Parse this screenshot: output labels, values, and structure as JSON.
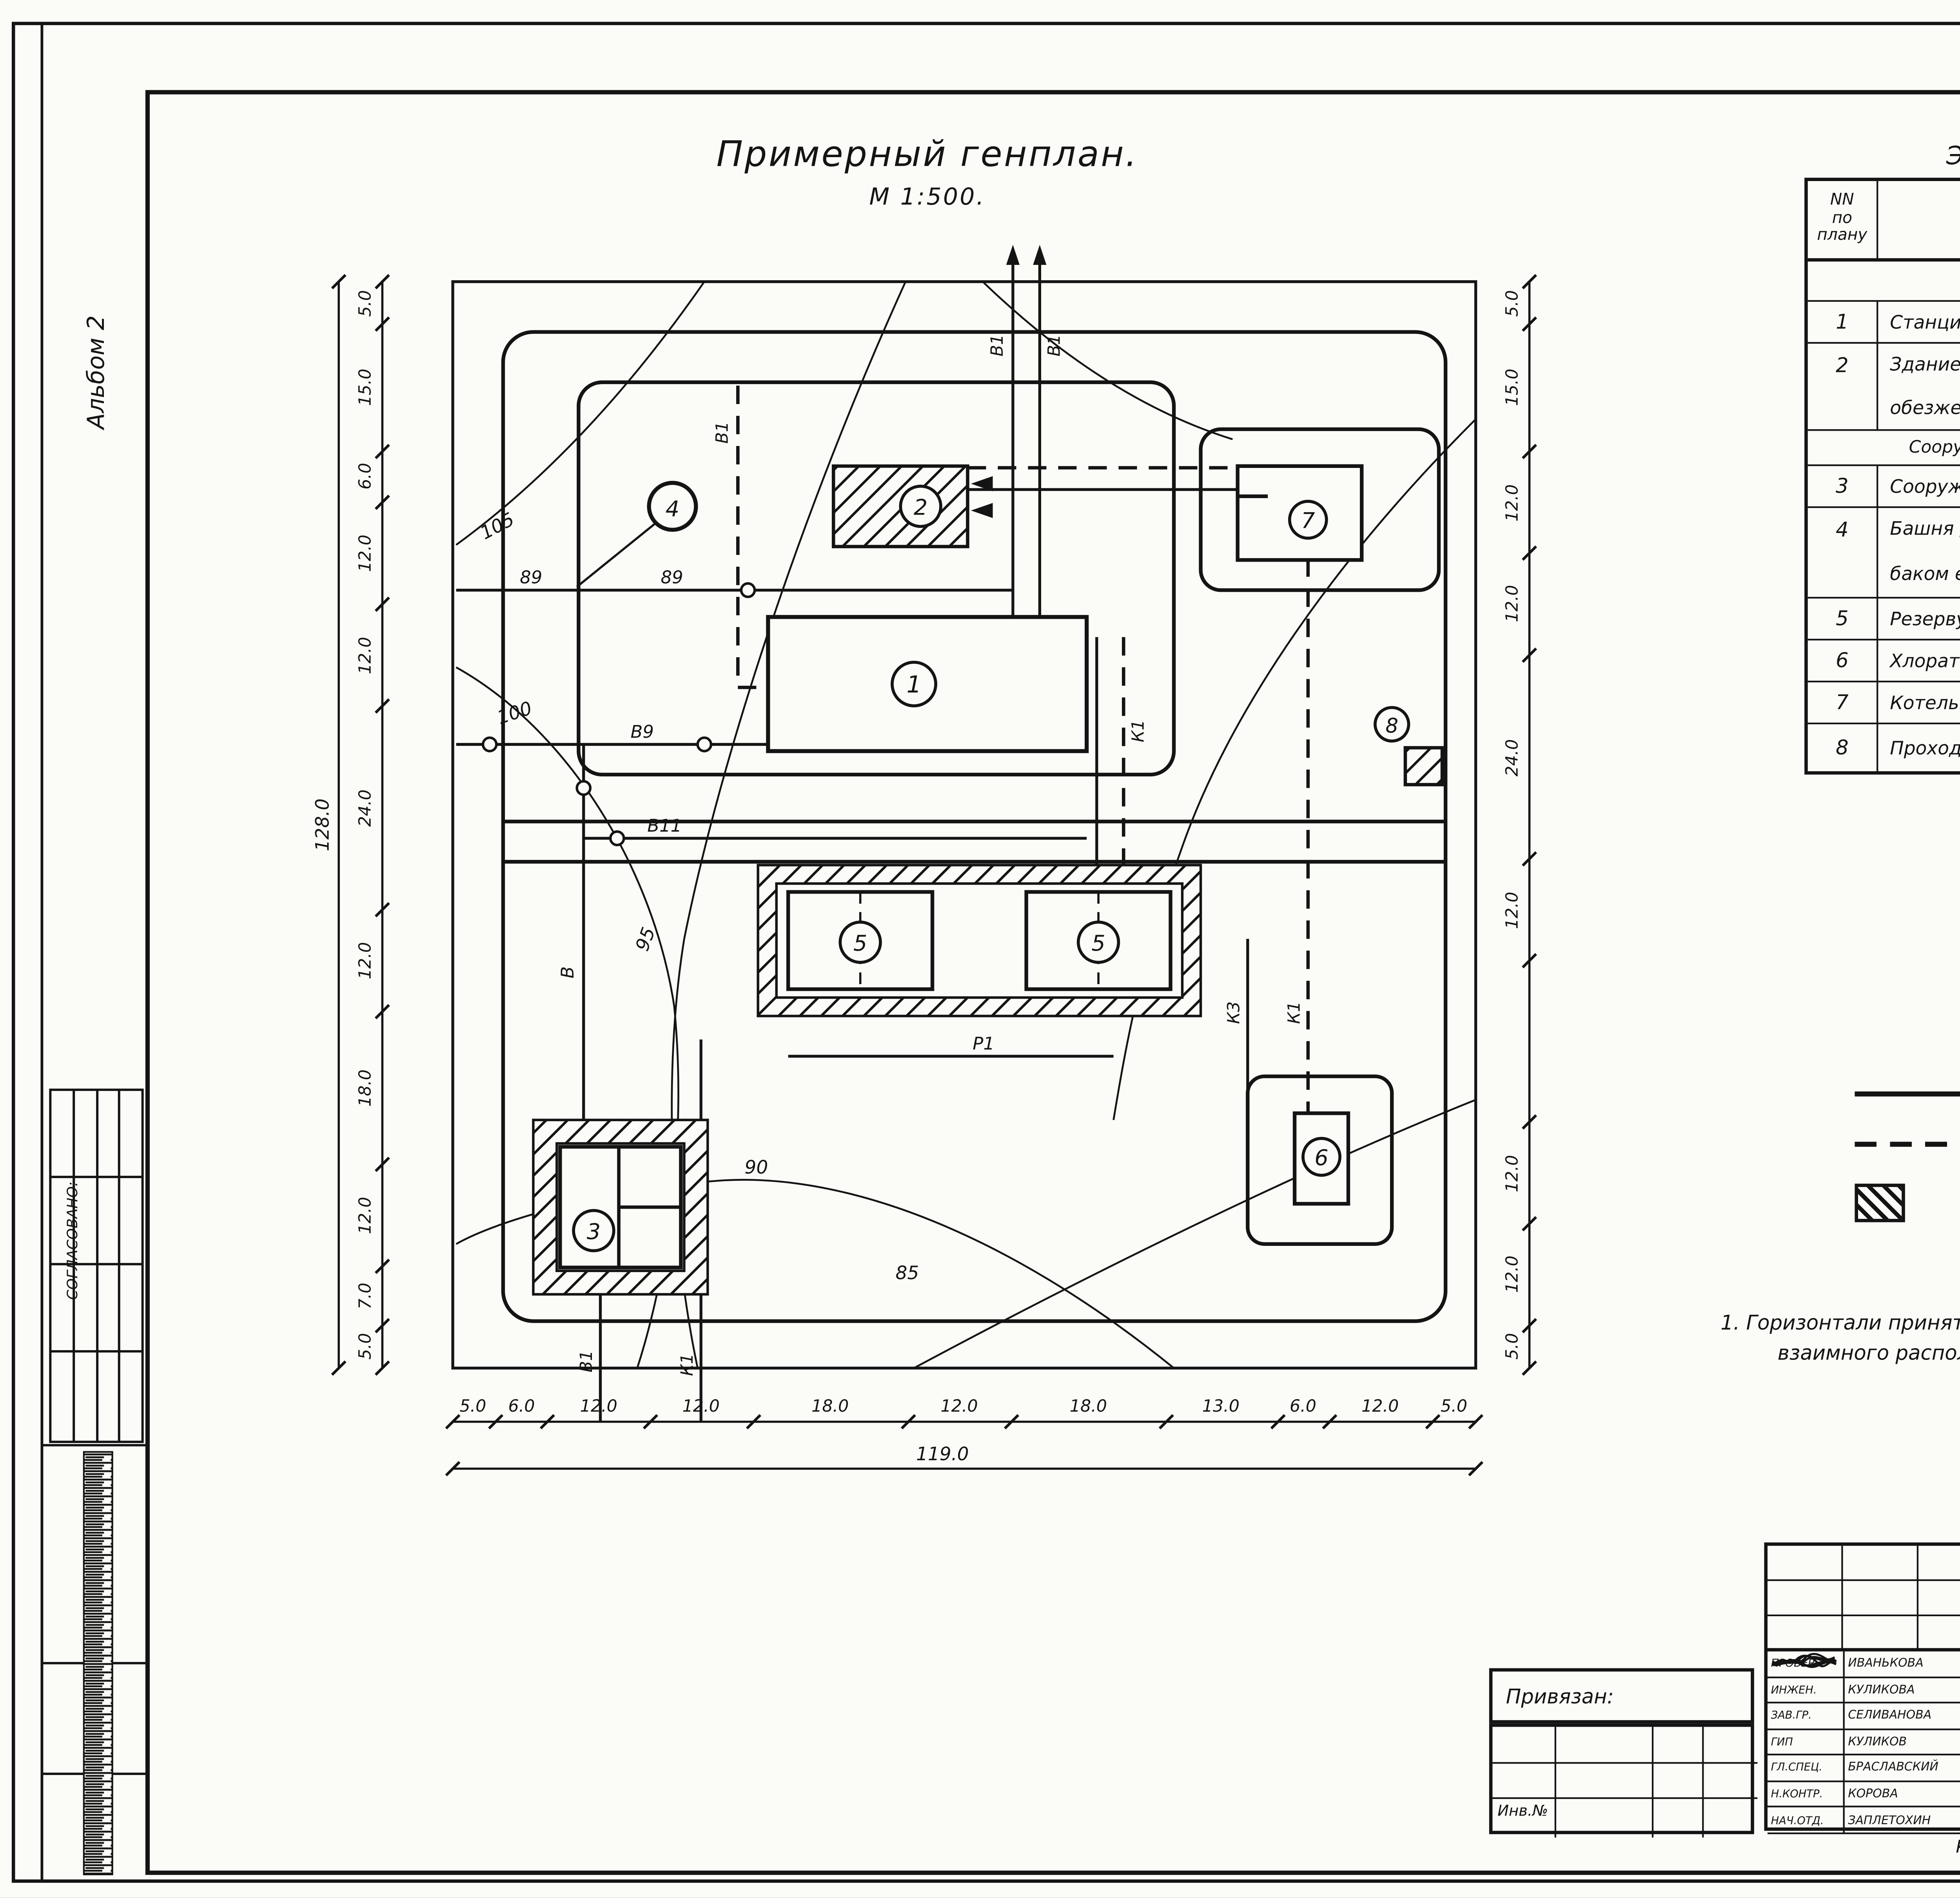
{
  "page": {
    "number": "11",
    "album": "Альбом 2",
    "agreed": "СОГЛАСОВАНО:",
    "format": "ФОРМАТ: А2",
    "doc_code": "0-1080-02",
    "copied": "Копировал: Логинова"
  },
  "plan": {
    "title": "Примерный генплан.",
    "scale": "М 1:500.",
    "building_nums": {
      "b1": "1",
      "b2": "2",
      "b3": "3",
      "b4": "4",
      "b5a": "5",
      "b5b": "5",
      "b6": "6",
      "b7": "7",
      "b8": "8"
    },
    "labels": {
      "v1_r1": "В1",
      "v1_r2": "В1",
      "v1_lv": "В1",
      "v1_lh": "В1",
      "v9": "В9",
      "v": "В",
      "v10": "В10",
      "v11": "В11",
      "k3u": "К3",
      "k1u": "К1",
      "k3l": "К3",
      "k1l": "К1",
      "r1": "Р1",
      "n89a": "89",
      "n89b": "89",
      "b3v": "В1",
      "b3k": "К1",
      "c105": "105",
      "c100": "100",
      "c95": "95",
      "c90": "90",
      "c85": "85"
    }
  },
  "dims": {
    "left": {
      "values": [
        "5.0",
        "15.0",
        "6.0",
        "12.0",
        "12.0",
        "24.0",
        "12.0",
        "18.0",
        "12.0",
        "7.0",
        "5.0"
      ],
      "total": "128.0"
    },
    "right": {
      "values": [
        "5.0",
        "15.0",
        "12.0",
        "12.0",
        "24.0",
        "12.0",
        "",
        "12.0",
        "12.0",
        "5.0"
      ]
    },
    "bottom": {
      "values": [
        "5.0",
        "6.0",
        "12.0",
        "12.0",
        "18.0",
        "12.0",
        "18.0",
        "13.0",
        "6.0",
        "12.0",
        "5.0"
      ],
      "total": "119.0"
    }
  },
  "table": {
    "title": "Экспликация зданий и сооружений.",
    "col_num": "NN\nпо\nплану",
    "col_name": "Наименование",
    "col_project": "Номер\nтипового\nпроекта",
    "sections": {
      "s1": "Проектируемые сооружения",
      "s2": "Сооружения, рекомендуемые для применения при привязке."
    },
    "rows": [
      {
        "num": "1",
        "name": "Станция обезжелезивания",
        "proj": "901-3-"
      },
      {
        "num": "2",
        "name": "Здание бактерицидной установки для станции",
        "proj": "901-3"
      },
      {
        "num": "",
        "name": "обезжелезивания.",
        "proj": ""
      },
      {
        "num": "3",
        "name": "Сооружения по обороту промывной воды",
        "proj": "901-3-249.88"
      },
      {
        "num": "4",
        "name": "Башня для хранения промывной воды",
        "proj": ""
      },
      {
        "num": "",
        "name": "баком емкостью 200м³",
        "proj": "901-3-24"
      },
      {
        "num": "5",
        "name": "Резервуары чистой воды  W=2×700м³",
        "proj": "901-4-59.83"
      },
      {
        "num": "6",
        "name": "Хлораторная на 2кг хлора в час.",
        "proj": "901-7-4.84"
      },
      {
        "num": "7",
        "name": "Котельная",
        "proj": ""
      },
      {
        "num": "8",
        "name": "Проходная",
        "proj": ""
      }
    ]
  },
  "legend": {
    "title": "Условные обозначения",
    "item1": "Обеззараживание хлорной водой (Вариант I)",
    "item2": "Обеззараживание бактерицидным облучением(Вариант II)"
  },
  "note": {
    "title": "Примечание.",
    "line1": "1. Горизонтали приняты условно для обозначения",
    "line2": "взаимного расположения сооружений на рельефе."
  },
  "titleblock": {
    "doc": "ТПР901-3-0271.89",
    "mark": "ТХ",
    "project_lines": [
      "СТАНЦИЯ ОБЕЗЖЕЛЕЗИВАНИЯ ВОДЫ",
      "ПОДЗЕМНЫХ ИСТОЧНИКОВ С СОДЕРЖАНИЕМ",
      "ЖЕЛЕЗА ДО 10МГ/Л. ПРОИЗВОДИТЕЛЬ-",
      "НОСТЬЮ 5,0ТЫС. М3/СУТ."
    ],
    "sheet_name": "Примерный генплан",
    "org_lines": [
      "ЦНИИЭП",
      "ИНЖЕНЕРНОГО ОБОРУДОВАНИЯ",
      "г. Москва"
    ],
    "stage_h": "СТАДИЯ",
    "sheet_h": "ЛИСТ",
    "sheets_h": "ЛИСТОВ",
    "stage": "Р",
    "sheet": "2",
    "sheets": "",
    "attached": "Привязан:",
    "inv": "Инв.№",
    "people": [
      {
        "role": "ПРОВЕР.",
        "name": "ИВАНЬКОВА"
      },
      {
        "role": "ИНЖЕН.",
        "name": "КУЛИКОВА"
      },
      {
        "role": "ЗАВ.ГР.",
        "name": "СЕЛИВАНОВА"
      },
      {
        "role": "ГИП",
        "name": "КУЛИКОВ"
      },
      {
        "role": "ГЛ.СПЕЦ.",
        "name": "БРАСЛАВСКИЙ"
      },
      {
        "role": "Н.КОНТР.",
        "name": "КОРОВА"
      },
      {
        "role": "НАЧ.ОТД.",
        "name": "ЗАПЛЕТОХИН"
      }
    ]
  }
}
